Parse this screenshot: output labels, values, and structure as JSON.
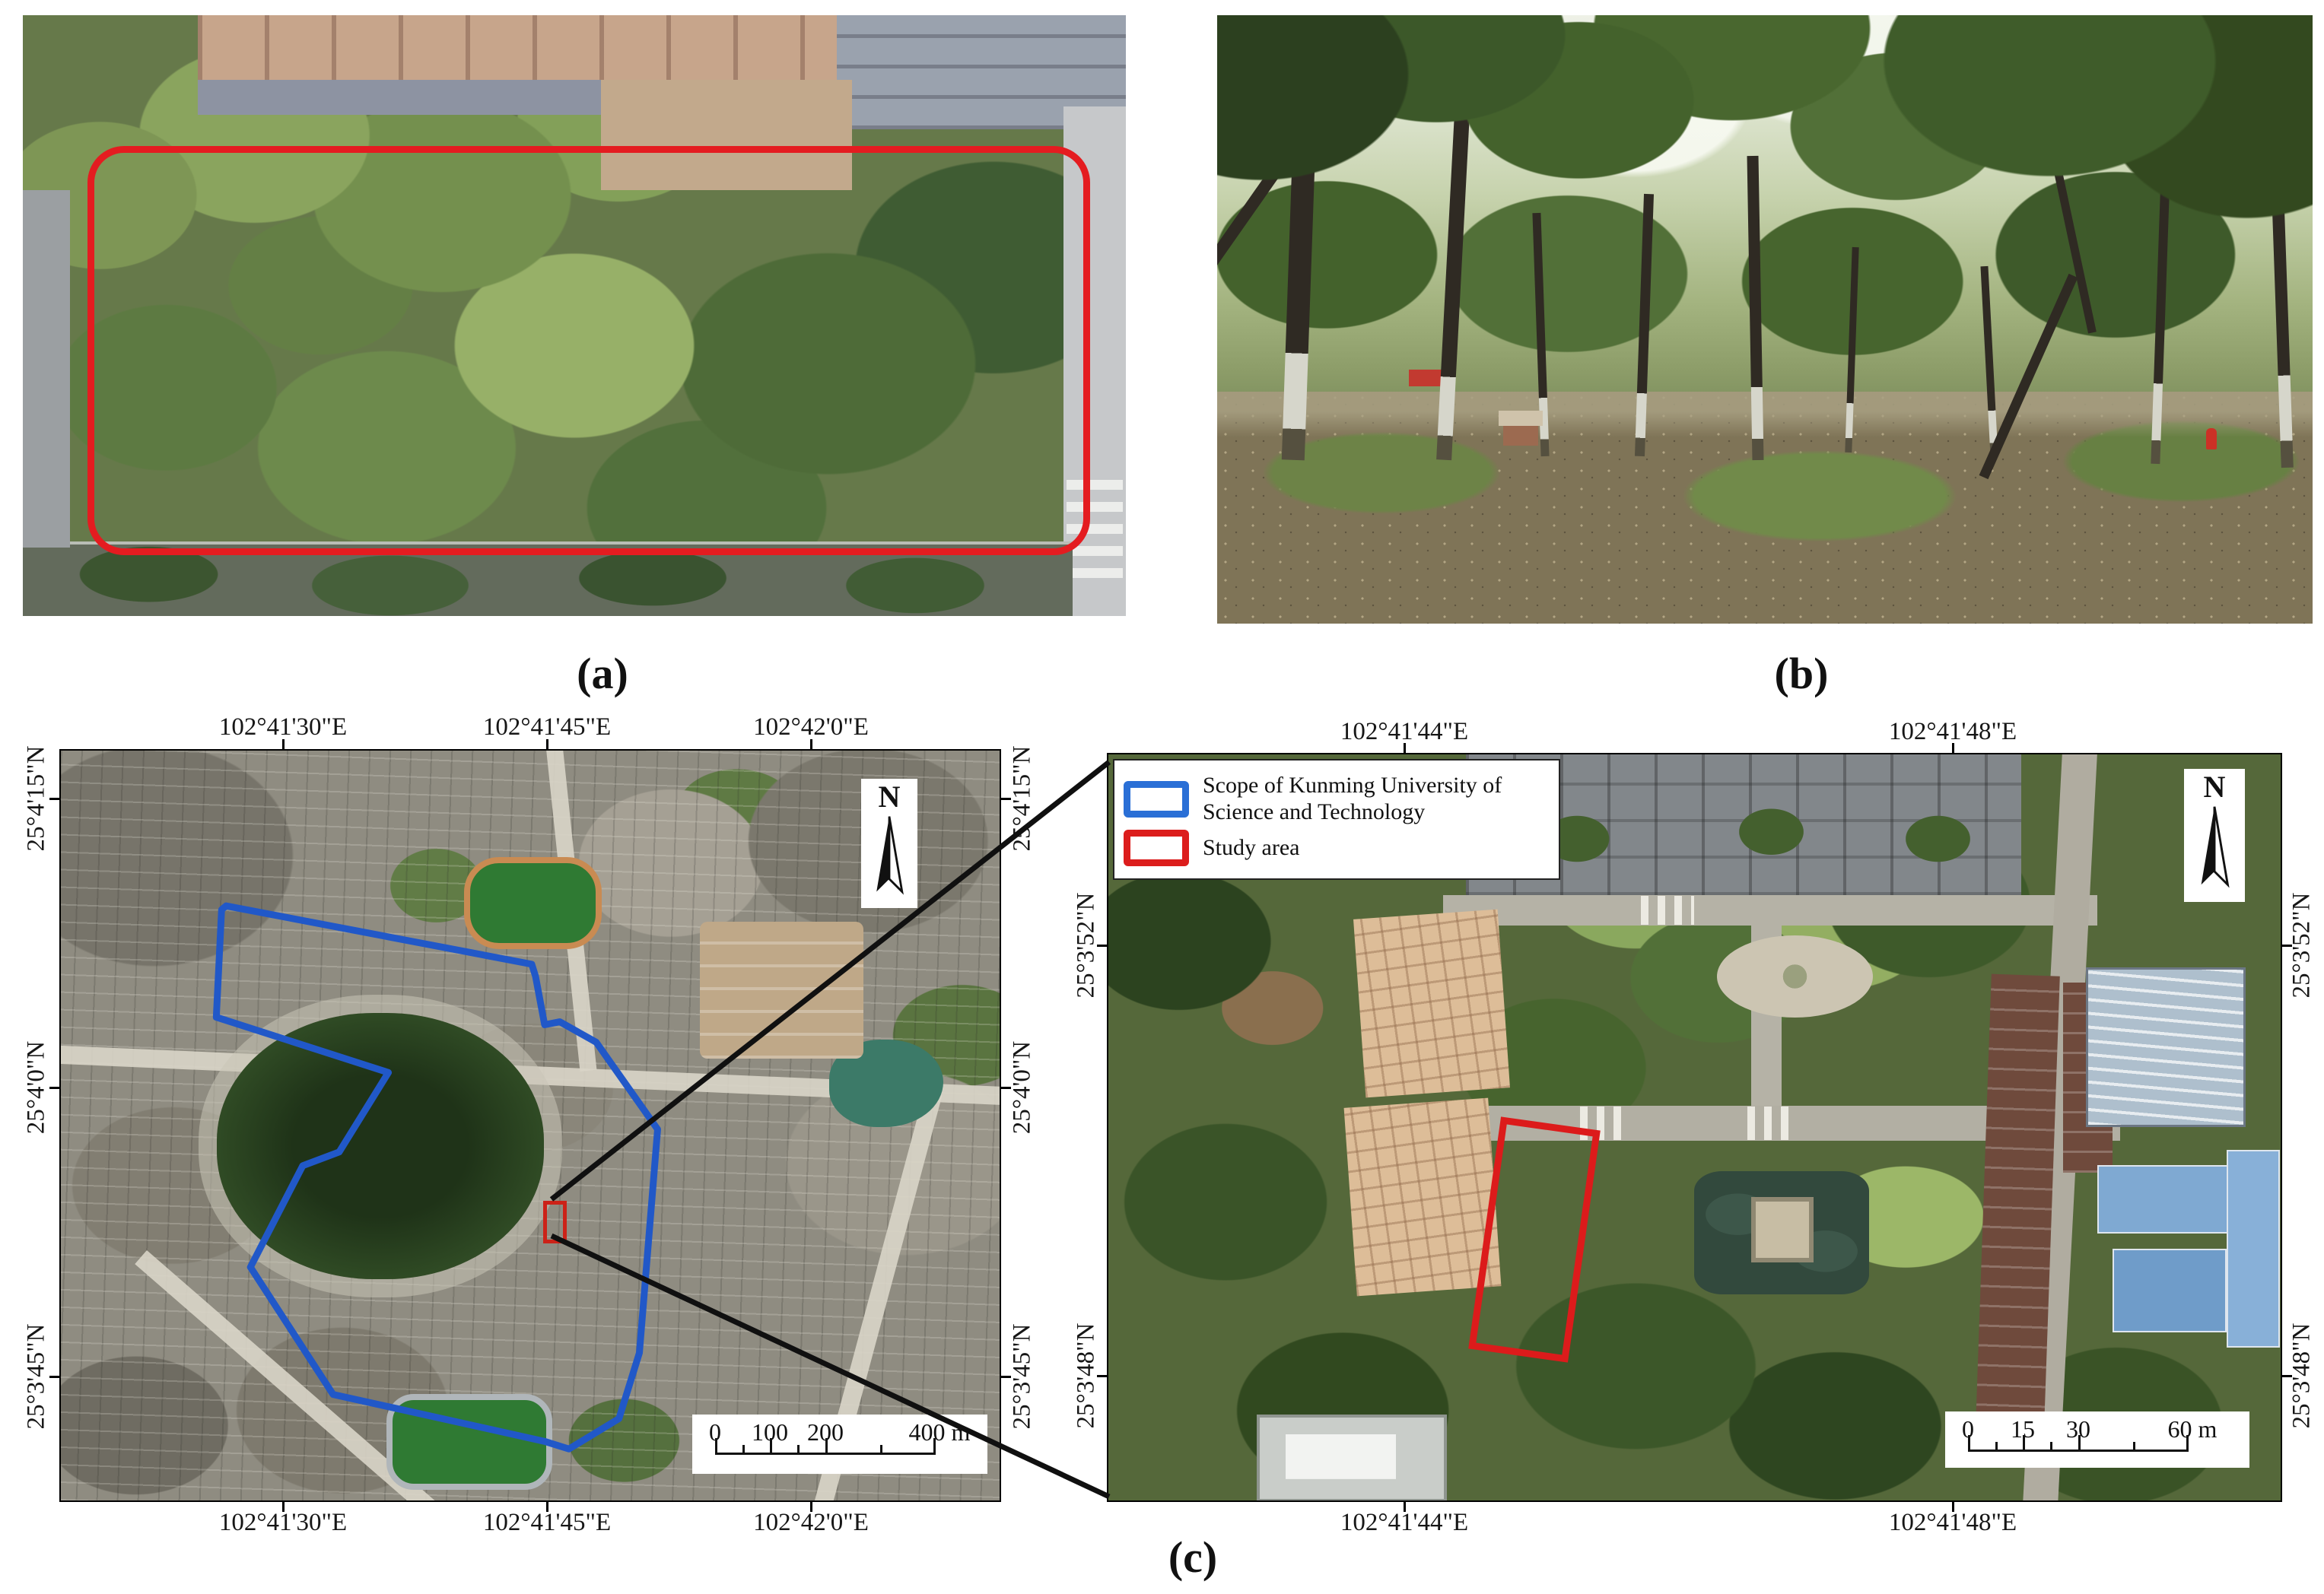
{
  "panel_labels": {
    "a": "(a)",
    "b": "(b)",
    "c": "(c)"
  },
  "left_map": {
    "lon": [
      "102°41'30\"E",
      "102°41'45\"E",
      "102°42'0\"E"
    ],
    "lat": [
      "25°4'15\"N",
      "25°4'0\"N",
      "25°3'45\"N"
    ],
    "north": "N",
    "scale": {
      "t0": "0",
      "t1": "100",
      "t2": "200",
      "t3": "400 m"
    }
  },
  "right_map": {
    "lon": [
      "102°41'44\"E",
      "102°41'48\"E"
    ],
    "lat": [
      "25°3'52\"N",
      "25°3'48\"N"
    ],
    "north": "N",
    "scale": {
      "t0": "0",
      "t1": "15",
      "t2": "30",
      "t3": "60 m"
    },
    "legend": {
      "scope": "Scope of Kunming University of Science and Technology",
      "study": "Study area",
      "scope_color": "#2A6FD6",
      "study_color": "#DC1D1C"
    }
  },
  "annotations": {
    "study_area_outline_color": "#E41C20",
    "campus_outline_color": "#2158C8"
  }
}
